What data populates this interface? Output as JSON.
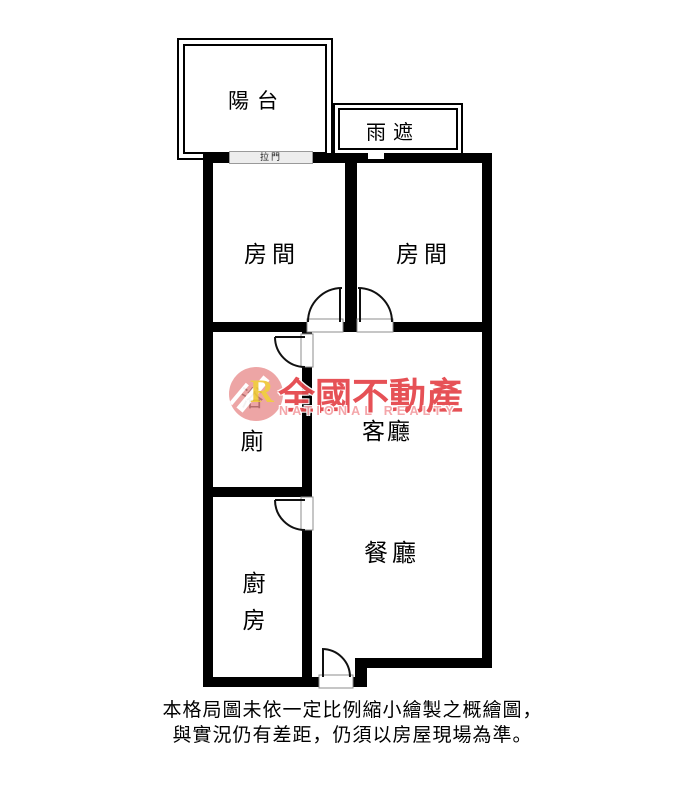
{
  "floorplan": {
    "rooms": {
      "balcony": "陽台",
      "rain_cover": "雨遮",
      "sliding_door": "拉門",
      "bedroom_left": "房間",
      "bedroom_right": "房間",
      "bathroom_char1": "浴",
      "bathroom_char2": "廁",
      "living_room": "客廳",
      "dining_room": "餐廳",
      "kitchen_char1": "廚",
      "kitchen_char2": "房"
    },
    "watermark": {
      "brand": "全國不動產",
      "brand_en": "NATIONAL REALTY",
      "logo_letter": "R"
    },
    "disclaimer": {
      "line1": "本格局圖未依一定比例縮小繪製之概繪圖，",
      "line2": "與實況仍有差距，仍須以房屋現場為準。"
    },
    "colors": {
      "wall": "#000000",
      "brand_red": "#e5484d",
      "brand_pink": "#f4a2a6",
      "logo_circle": "#e98f8f",
      "logo_yellow": "#f0c93d",
      "door_outline": "#8c8c8c"
    }
  }
}
